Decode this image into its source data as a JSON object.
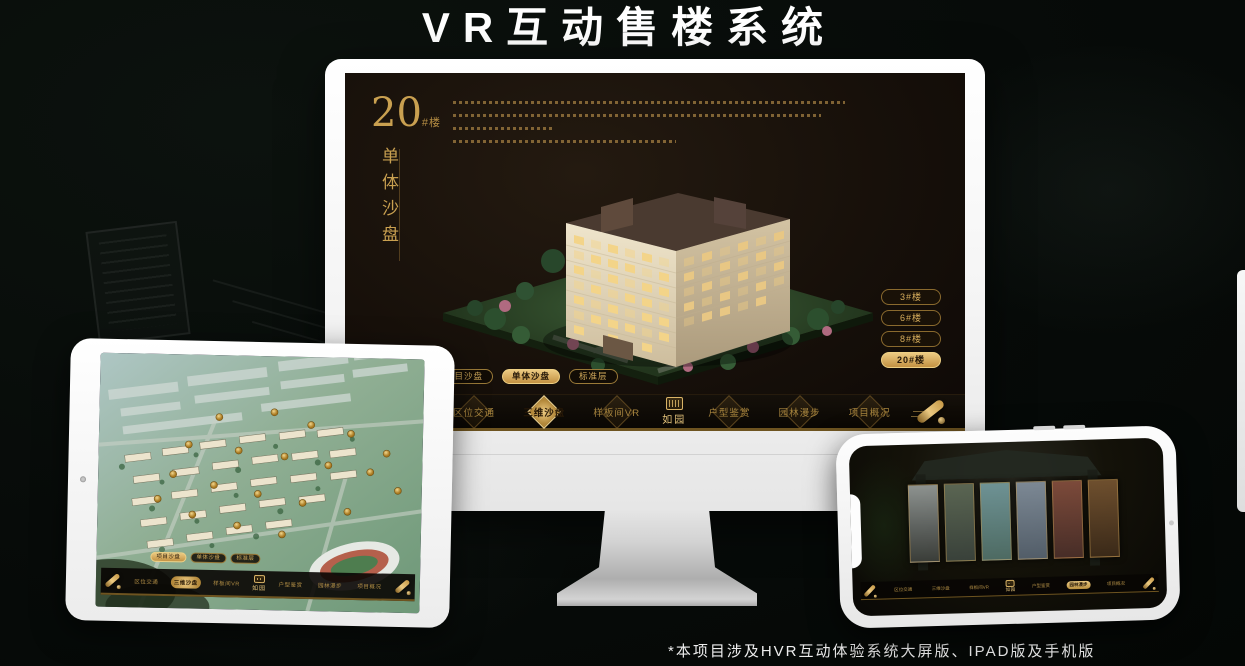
{
  "header": {
    "title": "VR互动售楼系统"
  },
  "footnote": "*本项目涉及HVR互动体验系统大屏版、IPAD版及手机版",
  "app": {
    "logo": "如园",
    "nav_items": [
      "区位交通",
      "三维沙盘",
      "样板间VR",
      "户型鉴赏",
      "园林漫步",
      "项目概况"
    ],
    "sub_tabs": [
      "项目沙盘",
      "单体沙盘",
      "标准层"
    ],
    "building_buttons": [
      "3#楼",
      "6#楼",
      "8#楼",
      "20#楼"
    ],
    "monitor_panel": {
      "block_number": "20",
      "block_unit": "#楼",
      "block_title_vertical": "单体沙盘"
    }
  },
  "colors": {
    "gold": "#c9a050",
    "gold_bright": "#ecca82",
    "screen_bg": "#17100a",
    "nav_bg": "#0a0703",
    "title_text": "#ffffff"
  }
}
